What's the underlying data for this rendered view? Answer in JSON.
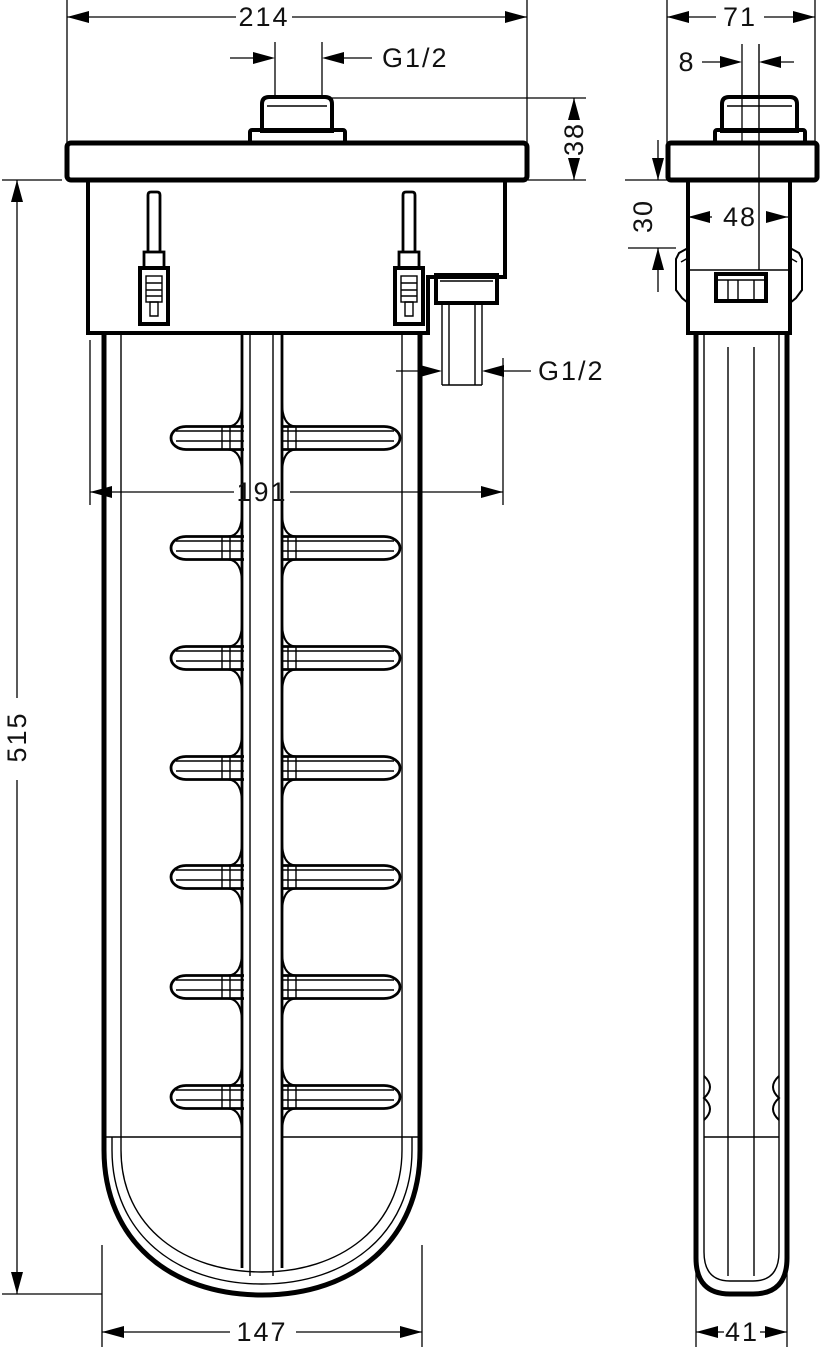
{
  "drawing": {
    "unit": "mm",
    "colors": {
      "line": "#000000",
      "background": "#ffffff"
    },
    "dimensions": {
      "front_flange_width": "214",
      "front_thread_top": "G1/2",
      "front_rim_height": "38",
      "front_outlet_thread": "G1/2",
      "front_body_width": "191",
      "front_body_height": "515",
      "front_bottom_width": "147",
      "side_flange_depth": "71",
      "side_center_offset": "8",
      "side_clip_depth": "30",
      "side_box_depth": "48",
      "side_bottom_depth": "41"
    }
  }
}
